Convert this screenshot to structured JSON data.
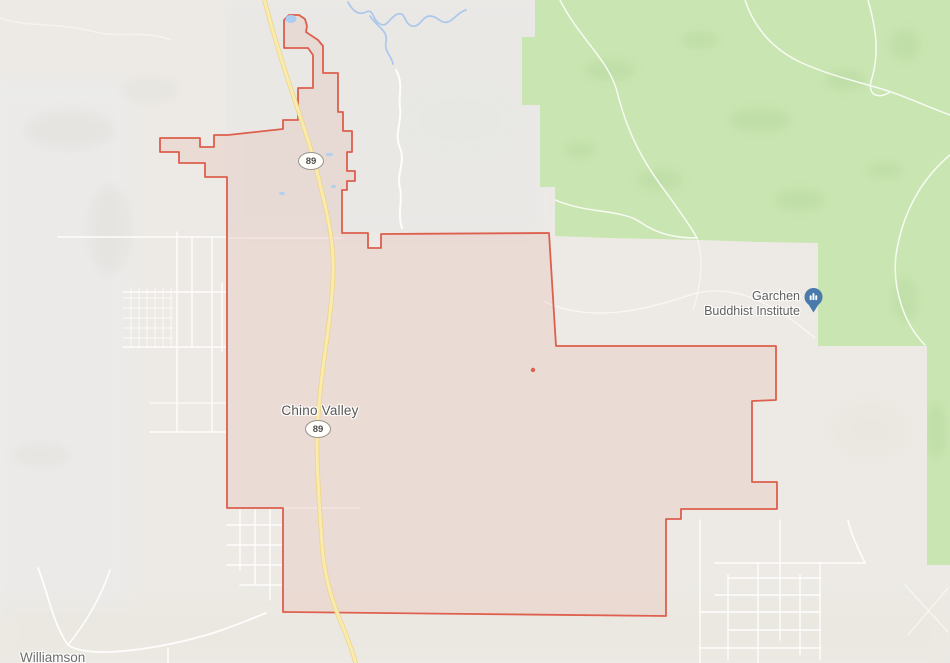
{
  "map_labels": {
    "town": "Chino Valley",
    "poi": {
      "line1": "Garchen",
      "line2": "Buddhist Institute"
    },
    "locality": "Williamson",
    "route_shield_north": "89",
    "route_shield_south": "89"
  },
  "icons": {
    "poi_pin": "buddhist-institute-place-pin"
  },
  "colors": {
    "map_background": "#edeae5",
    "boundary_red": "#dd5f4d",
    "boundary_fill": "rgba(219,90,70,0.10)",
    "highway_yellow": "#f9ebae",
    "highway_casing": "#ecd47f",
    "forest_green": "#c9e5b1",
    "forest_texture": "#b7d8a0",
    "water_blue": "#a9cef2",
    "river_blue": "#a8c6ea",
    "road_white": "#ffffff",
    "label_gray": "#5e5e5e",
    "poi_pin_blue": "#4a7aab"
  }
}
